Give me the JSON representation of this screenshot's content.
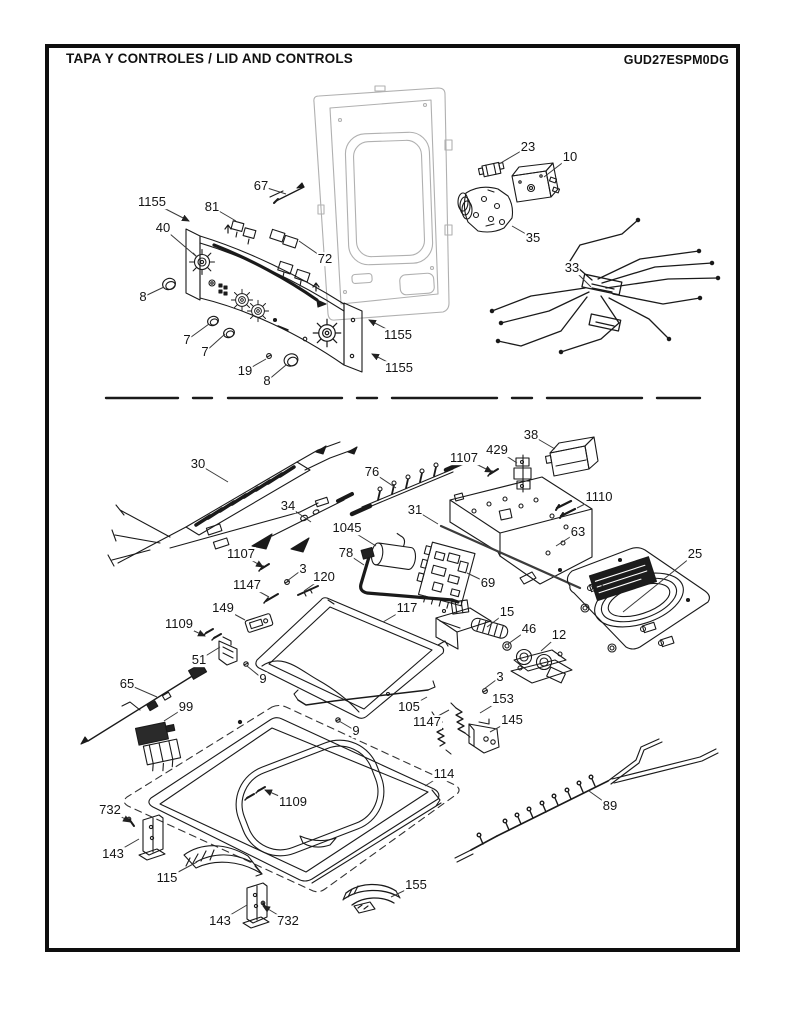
{
  "header": {
    "title": "TAPA Y  CONTROLES / LID AND CONTROLS",
    "model": "GUD27ESPM0DG"
  },
  "colors": {
    "line": "#1a1a1a",
    "cabinet_gray": "#b0b0b0",
    "leader": "#3a3a3a"
  },
  "diagram": {
    "description": "Exploded parts diagram: washer lid and control panel",
    "callouts": [
      {
        "label": "1155",
        "x": 152,
        "y": 202,
        "tx": 189,
        "ty": 221,
        "arrow": true
      },
      {
        "label": "40",
        "x": 163,
        "y": 228,
        "tx": 197,
        "ty": 257,
        "arrow": false
      },
      {
        "label": "67",
        "x": 261,
        "y": 186,
        "tx": 286,
        "ty": 194,
        "arrow": false
      },
      {
        "label": "81",
        "x": 212,
        "y": 207,
        "tx": 236,
        "ty": 221,
        "arrow": false
      },
      {
        "label": "72",
        "x": 325,
        "y": 259,
        "tx": 299,
        "ty": 241,
        "arrow": false
      },
      {
        "label": "8",
        "x": 143,
        "y": 297,
        "tx": 164,
        "ty": 287,
        "arrow": false
      },
      {
        "label": "7",
        "x": 187,
        "y": 340,
        "tx": 209,
        "ty": 324,
        "arrow": false
      },
      {
        "label": "7",
        "x": 205,
        "y": 352,
        "tx": 225,
        "ty": 334,
        "arrow": false
      },
      {
        "label": "19",
        "x": 245,
        "y": 371,
        "tx": 266,
        "ty": 359,
        "arrow": false
      },
      {
        "label": "8",
        "x": 267,
        "y": 381,
        "tx": 286,
        "ty": 365,
        "arrow": false
      },
      {
        "label": "1155",
        "x": 398,
        "y": 335,
        "tx": 369,
        "ty": 320,
        "arrow": true
      },
      {
        "label": "1155",
        "x": 399,
        "y": 368,
        "tx": 372,
        "ty": 354,
        "arrow": true
      },
      {
        "label": "23",
        "x": 528,
        "y": 147,
        "tx": 499,
        "ty": 164,
        "arrow": false
      },
      {
        "label": "10",
        "x": 570,
        "y": 157,
        "tx": 544,
        "ty": 177,
        "arrow": false
      },
      {
        "label": "35",
        "x": 533,
        "y": 238,
        "tx": 512,
        "ty": 226,
        "arrow": false
      },
      {
        "label": "33",
        "x": 572,
        "y": 268,
        "tx": 591,
        "ty": 287,
        "arrow": false
      },
      {
        "label": "30",
        "x": 198,
        "y": 464,
        "tx": 228,
        "ty": 482,
        "arrow": false
      },
      {
        "label": "34",
        "x": 288,
        "y": 506,
        "tx": 311,
        "ty": 522,
        "arrow": false
      },
      {
        "label": "76",
        "x": 372,
        "y": 472,
        "tx": 396,
        "ty": 488,
        "arrow": false
      },
      {
        "label": "1107",
        "x": 464,
        "y": 458,
        "tx": 492,
        "ty": 472,
        "arrow": true
      },
      {
        "label": "429",
        "x": 497,
        "y": 450,
        "tx": 517,
        "ty": 463,
        "arrow": false
      },
      {
        "label": "38",
        "x": 531,
        "y": 435,
        "tx": 555,
        "ty": 449,
        "arrow": false
      },
      {
        "label": "1110",
        "x": 599,
        "y": 497,
        "tx": 577,
        "ty": 508,
        "arrow": false
      },
      {
        "label": "63",
        "x": 578,
        "y": 532,
        "tx": 556,
        "ty": 546,
        "arrow": false
      },
      {
        "label": "31",
        "x": 415,
        "y": 510,
        "tx": 438,
        "ty": 524,
        "arrow": false
      },
      {
        "label": "1045",
        "x": 347,
        "y": 528,
        "tx": 376,
        "ty": 546,
        "arrow": false
      },
      {
        "label": "78",
        "x": 346,
        "y": 553,
        "tx": 364,
        "ty": 565,
        "arrow": false
      },
      {
        "label": "1107",
        "x": 241,
        "y": 554,
        "tx": 263,
        "ty": 567,
        "arrow": true
      },
      {
        "label": "3",
        "x": 303,
        "y": 569,
        "tx": 287,
        "ty": 581,
        "arrow": false
      },
      {
        "label": "120",
        "x": 324,
        "y": 577,
        "tx": 304,
        "ty": 591,
        "arrow": false
      },
      {
        "label": "1147",
        "x": 247,
        "y": 585,
        "tx": 269,
        "ty": 597,
        "arrow": false
      },
      {
        "label": "149",
        "x": 223,
        "y": 608,
        "tx": 245,
        "ty": 620,
        "arrow": false
      },
      {
        "label": "1109",
        "x": 179,
        "y": 624,
        "tx": 205,
        "ty": 636,
        "arrow": true
      },
      {
        "label": "51",
        "x": 199,
        "y": 660,
        "tx": 220,
        "ty": 647,
        "arrow": false
      },
      {
        "label": "9",
        "x": 263,
        "y": 679,
        "tx": 247,
        "ty": 666,
        "arrow": false
      },
      {
        "label": "117",
        "x": 407,
        "y": 608,
        "tx": 383,
        "ty": 622,
        "arrow": false
      },
      {
        "label": "15",
        "x": 507,
        "y": 612,
        "tx": 487,
        "ty": 627,
        "arrow": false
      },
      {
        "label": "46",
        "x": 529,
        "y": 629,
        "tx": 508,
        "ty": 644,
        "arrow": false
      },
      {
        "label": "12",
        "x": 559,
        "y": 635,
        "tx": 541,
        "ty": 651,
        "arrow": false
      },
      {
        "label": "69",
        "x": 488,
        "y": 583,
        "tx": 467,
        "ty": 573,
        "arrow": false
      },
      {
        "label": "25",
        "x": 695,
        "y": 554,
        "tx": 623,
        "ty": 612,
        "arrow": false
      },
      {
        "label": "3",
        "x": 500,
        "y": 677,
        "tx": 484,
        "ty": 689,
        "arrow": false
      },
      {
        "label": "153",
        "x": 503,
        "y": 699,
        "tx": 480,
        "ty": 713,
        "arrow": false
      },
      {
        "label": "145",
        "x": 512,
        "y": 720,
        "tx": 490,
        "ty": 732,
        "arrow": false
      },
      {
        "label": "105",
        "x": 409,
        "y": 707,
        "tx": 427,
        "ty": 697,
        "arrow": false
      },
      {
        "label": "1147",
        "x": 427,
        "y": 722,
        "tx": 449,
        "ty": 710,
        "arrow": false
      },
      {
        "label": "9",
        "x": 356,
        "y": 731,
        "tx": 339,
        "ty": 721,
        "arrow": false
      },
      {
        "label": "65",
        "x": 127,
        "y": 684,
        "tx": 157,
        "ty": 697,
        "arrow": false
      },
      {
        "label": "99",
        "x": 186,
        "y": 707,
        "tx": 164,
        "ty": 721,
        "arrow": false
      },
      {
        "label": "114",
        "x": 444,
        "y": 774,
        "tx": 425,
        "ty": 786,
        "arrow": false
      },
      {
        "label": "1109",
        "x": 293,
        "y": 802,
        "tx": 265,
        "ty": 790,
        "arrow": true
      },
      {
        "label": "732",
        "x": 110,
        "y": 810,
        "tx": 130,
        "ty": 822,
        "arrow": true
      },
      {
        "label": "143",
        "x": 113,
        "y": 854,
        "tx": 139,
        "ty": 839,
        "arrow": false
      },
      {
        "label": "115",
        "x": 167,
        "y": 878,
        "tx": 197,
        "ty": 862,
        "arrow": false
      },
      {
        "label": "143",
        "x": 220,
        "y": 921,
        "tx": 247,
        "ty": 905,
        "arrow": false
      },
      {
        "label": "732",
        "x": 288,
        "y": 921,
        "tx": 263,
        "ty": 906,
        "arrow": true
      },
      {
        "label": "155",
        "x": 416,
        "y": 885,
        "tx": 391,
        "ty": 897,
        "arrow": false
      },
      {
        "label": "89",
        "x": 610,
        "y": 806,
        "tx": 589,
        "ty": 791,
        "arrow": false
      }
    ]
  }
}
